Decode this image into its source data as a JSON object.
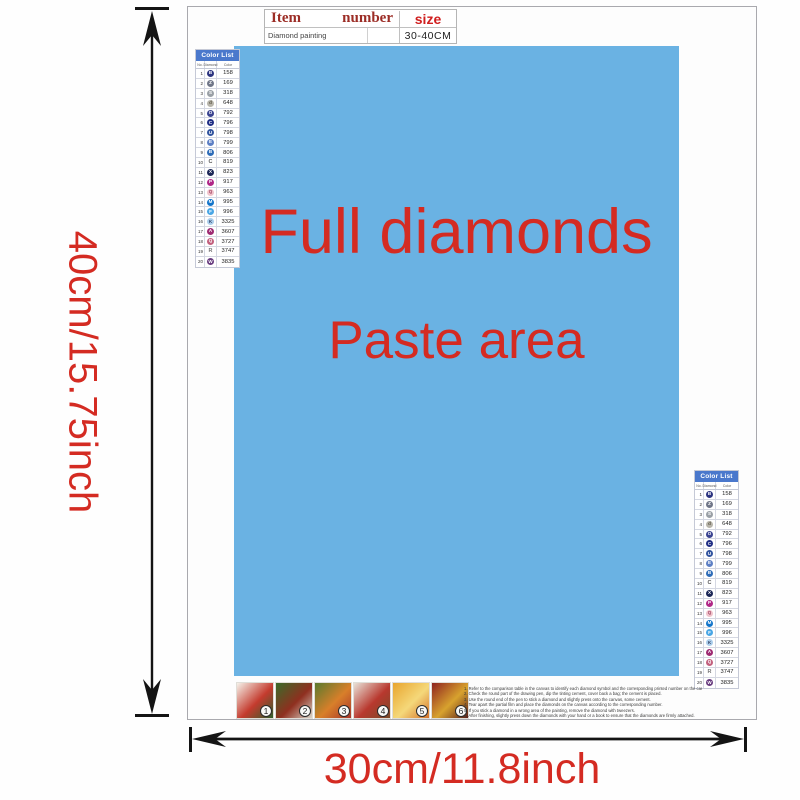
{
  "title_table": {
    "header": {
      "item": "Item",
      "number": "number",
      "size": "size"
    },
    "row": {
      "name": "Diamond painting",
      "number": "",
      "size": "30-40CM"
    }
  },
  "paste_area": {
    "line1": "Full diamonds",
    "line2": "Paste area",
    "bg_color": "#6ab2e3",
    "text_color": "#d42b22"
  },
  "dimension_labels": {
    "height": "40cm/15.75inch",
    "width": "30cm/11.8inch",
    "color": "#d42b22"
  },
  "color_list": {
    "title": "Color List",
    "header_bg": "#4a78cc",
    "columns": [
      "No.",
      "Diamond",
      "Color"
    ],
    "rows": [
      {
        "no": "1",
        "symbol": "B",
        "symbol_style": "circle",
        "circle_color": "#2c3480",
        "glyph_color": "#ffffff",
        "code": "158"
      },
      {
        "no": "2",
        "symbol": "Z",
        "symbol_style": "circle",
        "circle_color": "#707688",
        "glyph_color": "#ffffff",
        "code": "169"
      },
      {
        "no": "3",
        "symbol": "S",
        "symbol_style": "circle",
        "circle_color": "#9aa0a6",
        "glyph_color": "#ffffff",
        "code": "318"
      },
      {
        "no": "4",
        "symbol": "d",
        "symbol_style": "circle",
        "circle_color": "#b7b4aa",
        "glyph_color": "#55503f",
        "code": "648"
      },
      {
        "no": "5",
        "symbol": "O",
        "symbol_style": "circle",
        "circle_color": "#3a4390",
        "glyph_color": "#ffffff",
        "code": "792"
      },
      {
        "no": "6",
        "symbol": "C",
        "symbol_style": "circle",
        "circle_color": "#202e85",
        "glyph_color": "#ffffff",
        "code": "796"
      },
      {
        "no": "7",
        "symbol": "U",
        "symbol_style": "circle",
        "circle_color": "#32549f",
        "glyph_color": "#ffffff",
        "code": "798"
      },
      {
        "no": "8",
        "symbol": "E",
        "symbol_style": "circle",
        "circle_color": "#5d7fc4",
        "glyph_color": "#ffffff",
        "code": "799"
      },
      {
        "no": "9",
        "symbol": "B",
        "symbol_style": "circle",
        "circle_color": "#2e6cb8",
        "glyph_color": "#ffffff",
        "code": "806"
      },
      {
        "no": "10",
        "symbol": "C",
        "symbol_style": "plain",
        "circle_color": "",
        "glyph_color": "#555555",
        "code": "819"
      },
      {
        "no": "11",
        "symbol": "X",
        "symbol_style": "circle",
        "circle_color": "#1b2656",
        "glyph_color": "#ffffff",
        "code": "823"
      },
      {
        "no": "12",
        "symbol": "P",
        "symbol_style": "circle",
        "circle_color": "#b02787",
        "glyph_color": "#ffffff",
        "code": "917"
      },
      {
        "no": "13",
        "symbol": "Q",
        "symbol_style": "circle",
        "circle_color": "#f0c3cb",
        "glyph_color": "#a04060",
        "code": "963"
      },
      {
        "no": "14",
        "symbol": "M",
        "symbol_style": "circle",
        "circle_color": "#1173c9",
        "glyph_color": "#ffffff",
        "code": "995"
      },
      {
        "no": "15",
        "symbol": "F",
        "symbol_style": "circle",
        "circle_color": "#49a6e5",
        "glyph_color": "#ffffff",
        "code": "996"
      },
      {
        "no": "16",
        "symbol": "K",
        "symbol_style": "circle",
        "circle_color": "#abcdeb",
        "glyph_color": "#334466",
        "code": "3325"
      },
      {
        "no": "17",
        "symbol": "A",
        "symbol_style": "circle",
        "circle_color": "#9e2a72",
        "glyph_color": "#ffffff",
        "code": "3607"
      },
      {
        "no": "18",
        "symbol": "Q",
        "symbol_style": "circle",
        "circle_color": "#c2607e",
        "glyph_color": "#ffffff",
        "code": "3727"
      },
      {
        "no": "19",
        "symbol": "R",
        "symbol_style": "plain",
        "circle_color": "",
        "glyph_color": "#777777",
        "code": "3747"
      },
      {
        "no": "20",
        "symbol": "W",
        "symbol_style": "circle",
        "circle_color": "#693d80",
        "glyph_color": "#ffffff",
        "code": "3835"
      }
    ]
  },
  "footer": {
    "thumbnails": [
      {
        "num": "1",
        "colors": [
          "#f5f2ea",
          "#c43b2e",
          "#2e5e2c"
        ]
      },
      {
        "num": "2",
        "colors": [
          "#3a6b2a",
          "#8f2f1f",
          "#d8d4c8"
        ]
      },
      {
        "num": "3",
        "colors": [
          "#5a7a2e",
          "#d87f2a",
          "#a8352a"
        ]
      },
      {
        "num": "4",
        "colors": [
          "#e8e2d8",
          "#b8382e",
          "#7a4a28"
        ]
      },
      {
        "num": "5",
        "colors": [
          "#e8a52e",
          "#f5d87a",
          "#d4722a"
        ]
      },
      {
        "num": "6",
        "colors": [
          "#8f2420",
          "#d8a22e",
          "#5a1f1a"
        ]
      }
    ],
    "instructions": [
      "1. Refer to the comparison table in the canvas to identify each diamond symbol and the corresponding printed number on the canvas.",
      "2. Check the round part of the drawing pen, dip the tinting cement, cover back a bag; the cement is placed.",
      "3. Use the round end of the pen to stick a diamond and slightly press onto the canvas, some cement.",
      "4. Tear apart the partial film and place the diamonds on the canvas according to the corresponding number.",
      "5. If you stick a diamond in a wrong area of the painting, remove the diamond with tweezers.",
      "6. After finishing, slightly press down the diamonds with your hand or a book to ensure that the diamonds are firmly attached."
    ]
  }
}
